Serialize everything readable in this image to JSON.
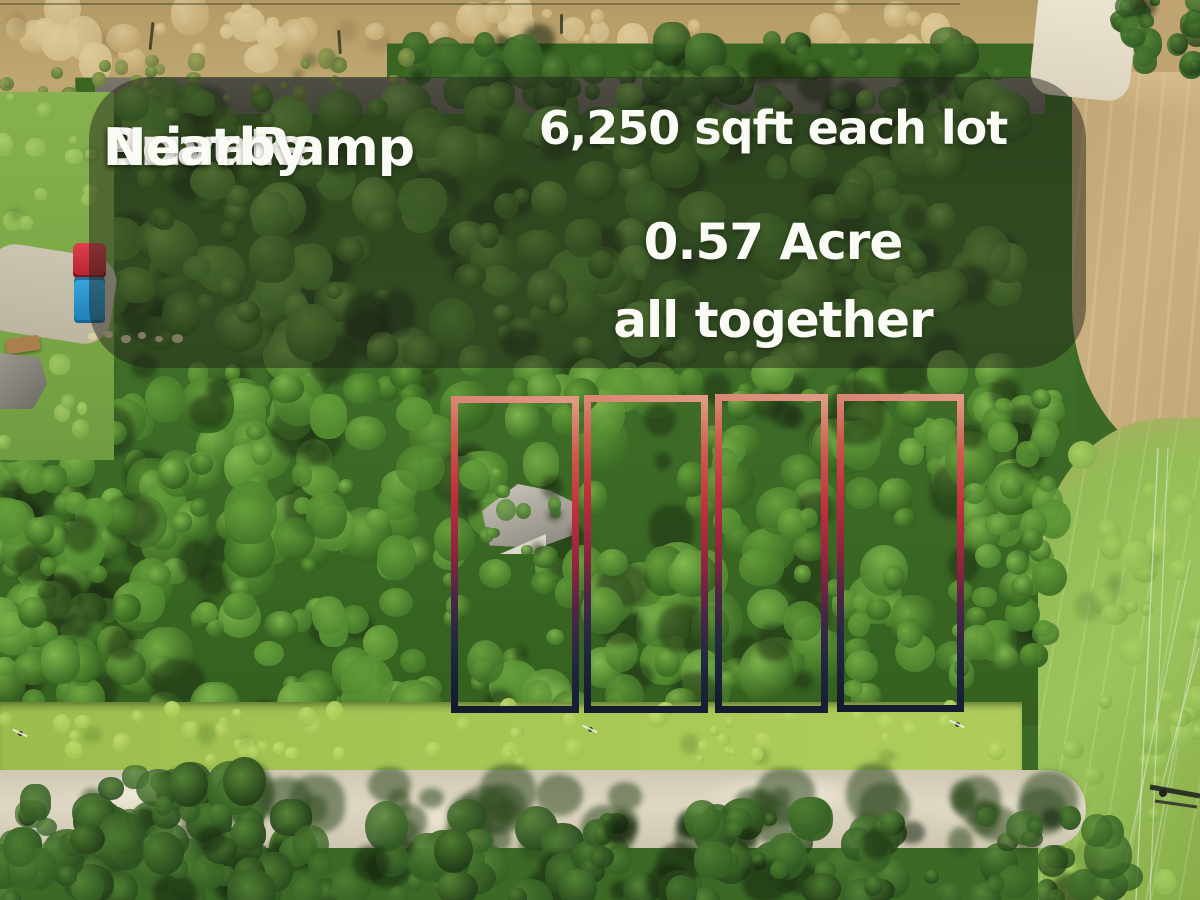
{
  "banner": {
    "left_lines": [
      "Private",
      "Boat Ramp",
      "Nearby"
    ],
    "right_lines": [
      "6,250 sqft each lot",
      "0.57 Acre",
      "all together"
    ],
    "background_color": "rgba(32,33,26,0.48)",
    "text_color": "#fbfbf6"
  },
  "lots": {
    "count": 4,
    "outline_gradient": [
      "#e09a85",
      "#c02e3d",
      "#8e2340",
      "#232843",
      "#131a2e"
    ]
  },
  "scene_colors": {
    "forest_green": "#41702a",
    "dry_field_tan": "#bfa771",
    "sandy_road": "#ded7c3",
    "truck_cab_red": "#c9303c",
    "truck_bed_blue": "#2a93cc"
  }
}
